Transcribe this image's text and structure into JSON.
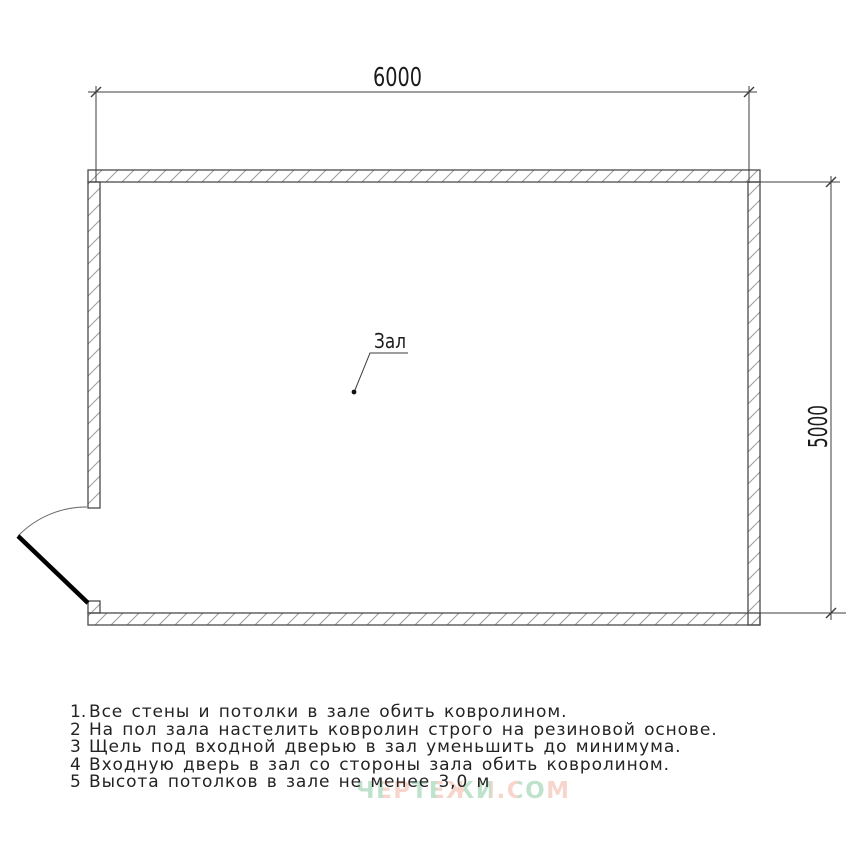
{
  "drawing": {
    "room_label": "Зал",
    "dimensions": {
      "width_mm": "6000",
      "height_mm": "5000"
    },
    "notes": [
      {
        "num": "1.",
        "text": "Все стены и потолки в зале обить ковролином."
      },
      {
        "num": "2",
        "text": "На пол зала настелить ковролин строго на резиновой основе."
      },
      {
        "num": "3",
        "text": "Щель под входной дверью в зал уменьшить до минимума."
      },
      {
        "num": "4",
        "text": "Входную дверь в зал со стороны зала обить ковролином."
      },
      {
        "num": "5",
        "text": "Высота потолков в зале не менее 3,0 м"
      }
    ],
    "watermark": {
      "text": "ЧЕРТЕЖИ.СОМ",
      "color_green": "#8bcba4",
      "color_salmon": "#f2b4a4"
    },
    "colors": {
      "wall_outline": "#4a4a4a",
      "hatch": "#9a9a9a",
      "dimension_line": "#3d3d3d",
      "door_leaf": "#000000",
      "background": "#ffffff"
    }
  }
}
